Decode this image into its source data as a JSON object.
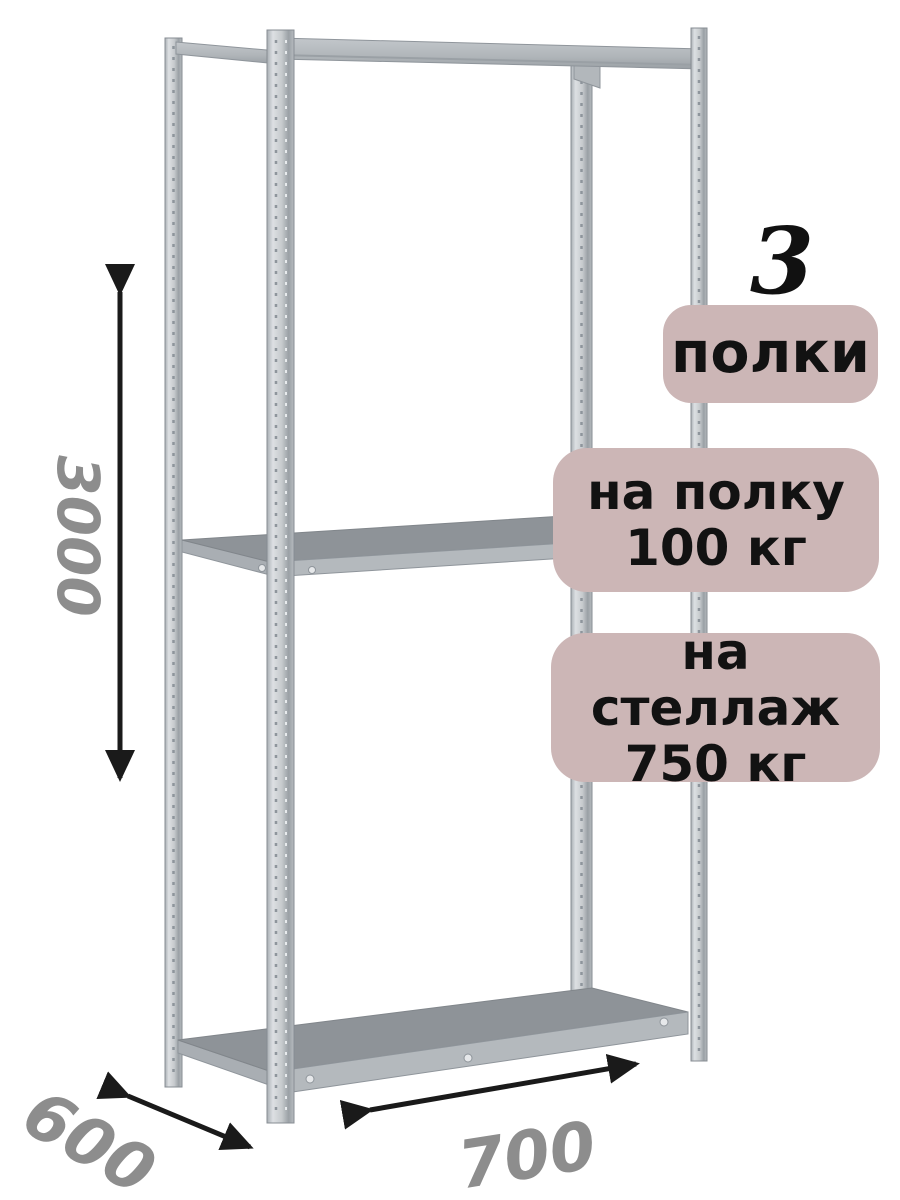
{
  "product_annotation": {
    "shelf_count": "3",
    "shelf_count_label": "полки",
    "per_shelf_load": {
      "line1": "на полку",
      "line2": "100 кг"
    },
    "per_rack_load": {
      "line1": "на стеллаж",
      "line2": "750 кг"
    }
  },
  "dimensions": {
    "height_mm": "3000",
    "depth_mm": "600",
    "width_mm": "700"
  },
  "icons": [
    "height-dimension-arrow-icon",
    "depth-dimension-arrow-icon",
    "width-dimension-arrow-icon"
  ],
  "colors": {
    "background": "#ffffff",
    "badge_background": "#ccb6b6",
    "badge_text": "#121212",
    "dimension_text": "#8d8d8d",
    "arrow": "#1a1a1a",
    "metal_post_light": "#d8dcdf",
    "metal_post_mid": "#c0c5c9",
    "metal_beam": "#b4b9bd",
    "shelf_top": "#8e9398",
    "metal_edge": "#878d93"
  }
}
